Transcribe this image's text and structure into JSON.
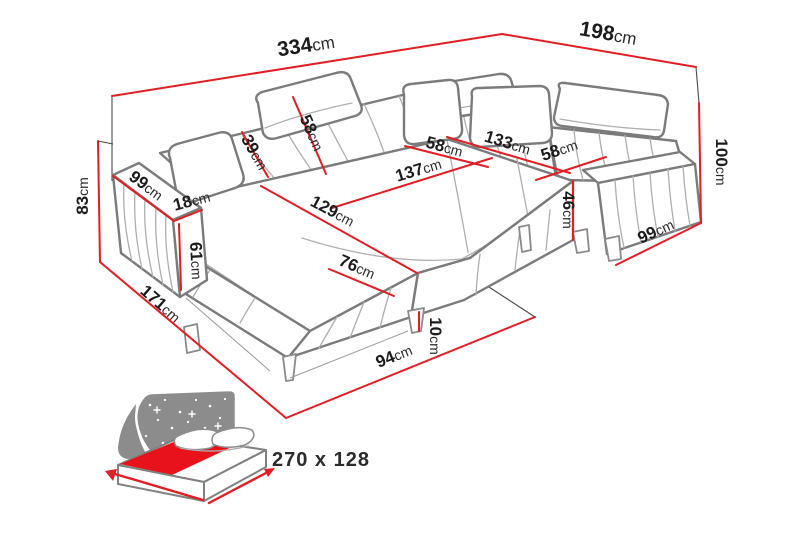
{
  "dimensions": {
    "back_width": {
      "value": "334",
      "unit": "cm"
    },
    "right_side_width": {
      "value": "198",
      "unit": "cm"
    },
    "back_height_left": {
      "value": "83",
      "unit": "cm"
    },
    "left_arm_depth": {
      "value": "99",
      "unit": "cm"
    },
    "arm_width": {
      "value": "18",
      "unit": "cm"
    },
    "arm_height_front": {
      "value": "61",
      "unit": "cm"
    },
    "left_side_depth": {
      "value": "171",
      "unit": "cm"
    },
    "backrest_height_39": {
      "value": "39",
      "unit": "cm"
    },
    "backrest_height_58": {
      "value": "58",
      "unit": "cm"
    },
    "chaise_length": {
      "value": "129",
      "unit": "cm"
    },
    "chaise_width": {
      "value": "76",
      "unit": "cm"
    },
    "middle_seat_width": {
      "value": "137",
      "unit": "cm"
    },
    "corner_seat_depth": {
      "value": "58",
      "unit": "cm"
    },
    "right_seat_width": {
      "value": "133",
      "unit": "cm"
    },
    "right_seat_depth": {
      "value": "58",
      "unit": "cm"
    },
    "seat_height": {
      "value": "46",
      "unit": "cm"
    },
    "right_arm_depth": {
      "value": "99",
      "unit": "cm"
    },
    "back_height_right": {
      "value": "100",
      "unit": "cm"
    },
    "front_floor_width": {
      "value": "94",
      "unit": "cm"
    },
    "leg_height": {
      "value": "10",
      "unit": "cm"
    }
  },
  "sleeping_area": {
    "label": "270 x 128"
  },
  "colors": {
    "dimension_red": "#e01e24",
    "text_dark": "#1c1c1c",
    "sofa_outline_gray": "#7b7b7b",
    "backdrop_gray": "#8c8c8c",
    "mattress_red": "#e8131a"
  },
  "icons": {
    "sleeping_area_icon": "bed-with-mattress-icon",
    "backdrop_icon": "starry-night-backdrop"
  }
}
